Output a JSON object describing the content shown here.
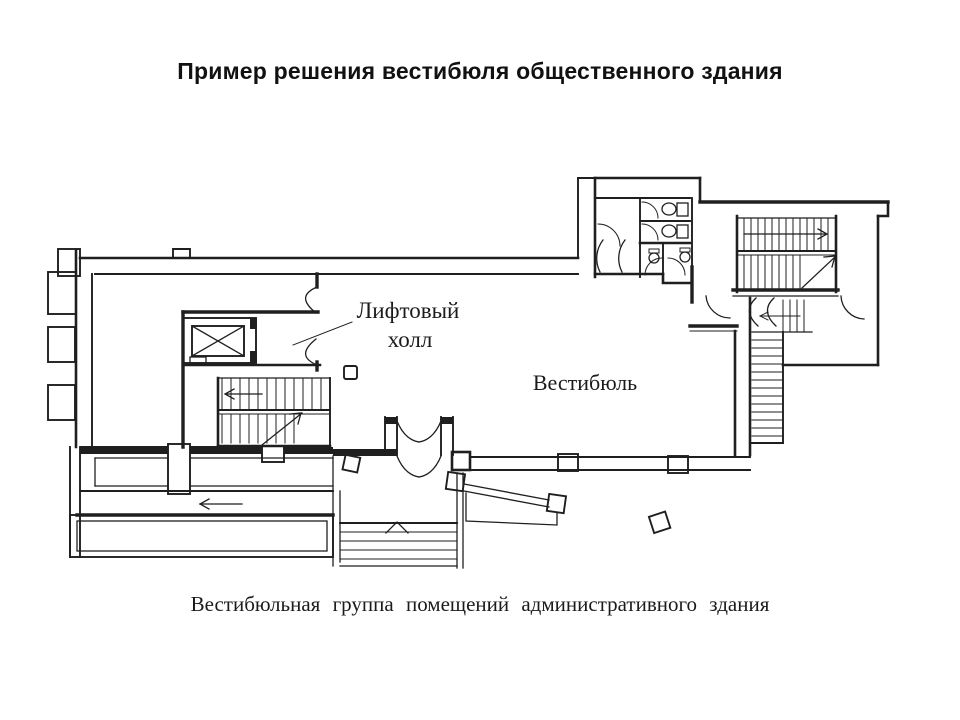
{
  "title": "Пример решения вестибюля общественного здания",
  "caption": "Вестибюльная группа помещений административного здания",
  "plan_labels": {
    "lift_hall_line1": "Лифтовый",
    "lift_hall_line2": "холл",
    "vestibule": "Вестибюль"
  },
  "colors": {
    "ink": "#1f1f1f",
    "paper": "#ffffff"
  }
}
